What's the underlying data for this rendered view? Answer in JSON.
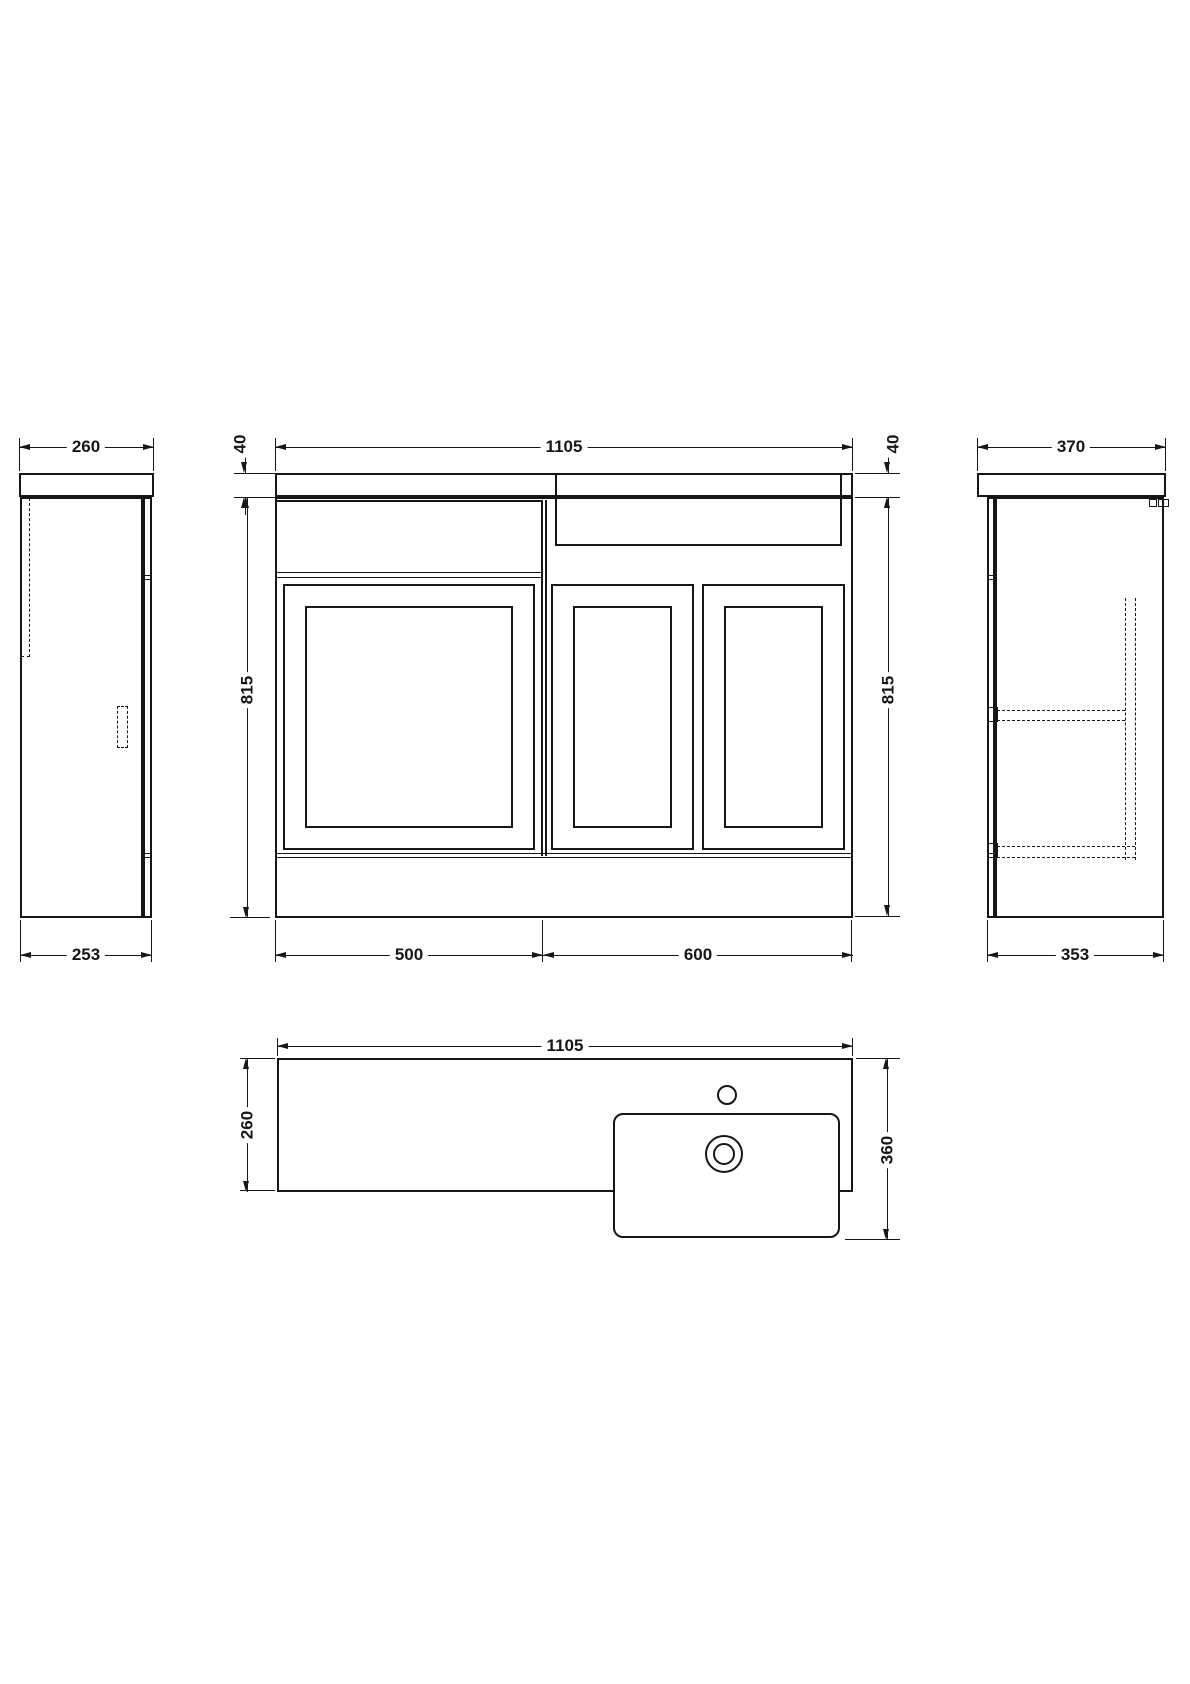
{
  "drawing": {
    "front": {
      "width": "1105",
      "counter_thickness_left": "40",
      "counter_thickness_right": "40",
      "height_left": "815",
      "height_right": "815",
      "section_left": "500",
      "section_right": "600"
    },
    "side_left": {
      "depth_top": "260",
      "depth_bottom": "253"
    },
    "side_right": {
      "depth_top": "370",
      "depth_bottom": "353"
    },
    "plan": {
      "width": "1105",
      "depth": "260",
      "basin_depth": "360"
    }
  },
  "colors": {
    "line": "#161616",
    "background": "#ffffff"
  }
}
